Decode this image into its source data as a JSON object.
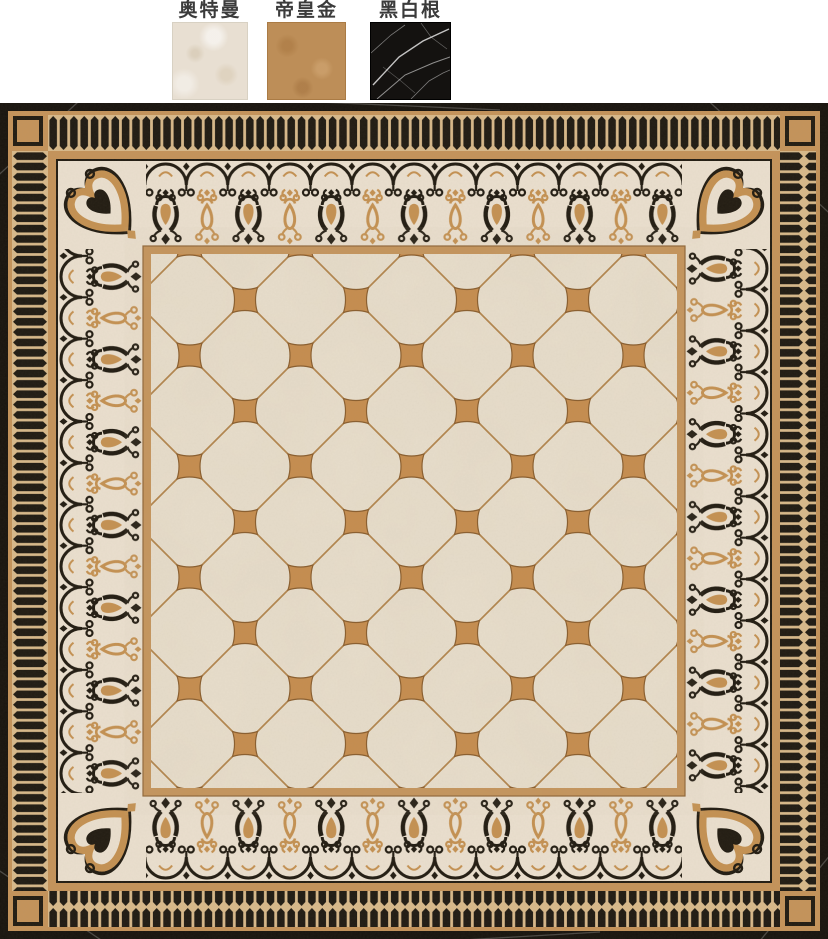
{
  "header": {
    "swatches": [
      {
        "label": "奥特曼",
        "color": "#e8dfd2"
      },
      {
        "label": "帝皇金",
        "color": "#bd8e58"
      },
      {
        "label": "黑白根",
        "color": "#141210",
        "vein_color": "#e3e3e3"
      }
    ]
  },
  "pattern": {
    "colors": {
      "edge-black": "#18140e",
      "tan": "#c4935a",
      "tan-dark": "#8f6536",
      "stripe-black": "#201b13",
      "stripe-gap": "#d8b98a",
      "ink": "#221c12",
      "gold": "#c49152",
      "cream": "#eadfce",
      "field-cream": "#e8decc",
      "grid-line": "#b2854e",
      "accent": "#c58d4f",
      "accent-edge": "#8a5e2e"
    }
  }
}
